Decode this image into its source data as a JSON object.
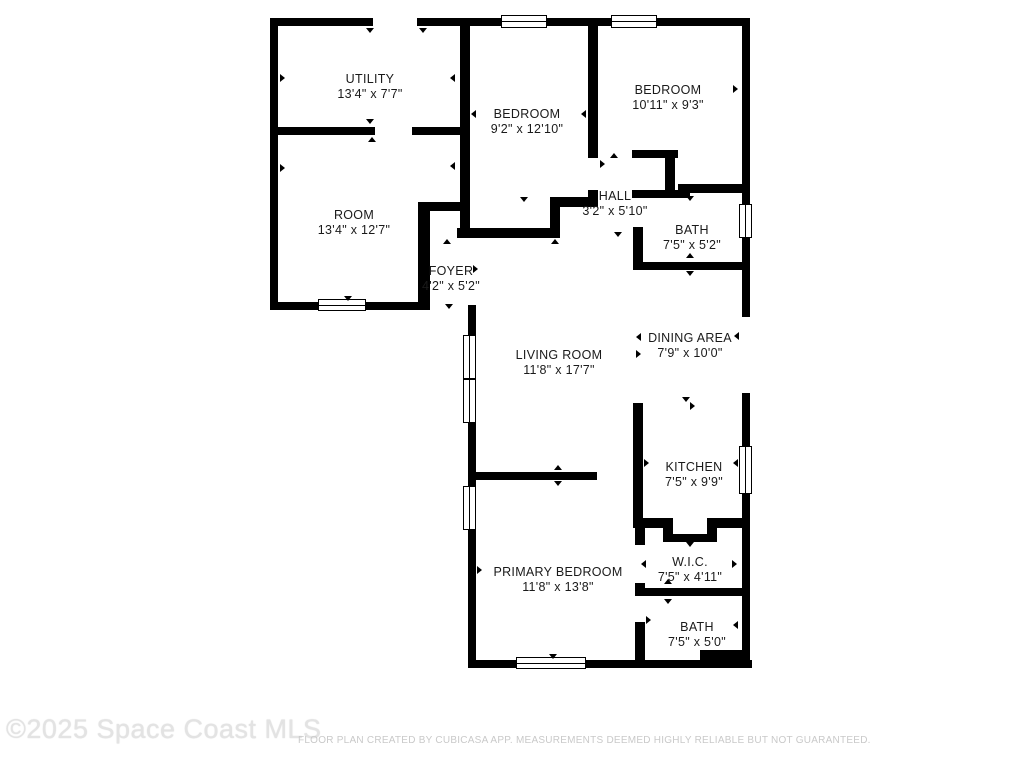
{
  "watermark": "©2025 Space Coast MLS",
  "disclaimer": "FLOOR PLAN CREATED BY CUBICASA APP. MEASUREMENTS DEEMED HIGHLY RELIABLE BUT NOT GUARANTEED.",
  "colors": {
    "wall": "#000000",
    "text": "#1a1a1a",
    "background": "#ffffff",
    "watermark": "#e3e3e3",
    "disclaimer": "#c9c9c9"
  },
  "floor_plan": {
    "rooms": [
      {
        "id": "utility",
        "name": "UTILITY",
        "dims": "13'4\" x 7'7\"",
        "cx": 370,
        "cy": 80
      },
      {
        "id": "bedroom-1",
        "name": "BEDROOM",
        "dims": "9'2\" x 12'10\"",
        "cx": 527,
        "cy": 115
      },
      {
        "id": "bedroom-2",
        "name": "BEDROOM",
        "dims": "10'11\" x 9'3\"",
        "cx": 668,
        "cy": 91
      },
      {
        "id": "room",
        "name": "ROOM",
        "dims": "13'4\" x 12'7\"",
        "cx": 354,
        "cy": 216
      },
      {
        "id": "hall",
        "name": "HALL",
        "dims": "3'2\" x 5'10\"",
        "cx": 615,
        "cy": 197
      },
      {
        "id": "bath-1",
        "name": "BATH",
        "dims": "7'5\" x 5'2\"",
        "cx": 692,
        "cy": 231
      },
      {
        "id": "foyer",
        "name": "FOYER",
        "dims": "4'2\" x 5'2\"",
        "cx": 451,
        "cy": 272
      },
      {
        "id": "living-room",
        "name": "LIVING ROOM",
        "dims": "11'8\" x 17'7\"",
        "cx": 559,
        "cy": 356
      },
      {
        "id": "dining-area",
        "name": "DINING AREA",
        "dims": "7'9\" x 10'0\"",
        "cx": 690,
        "cy": 339
      },
      {
        "id": "kitchen",
        "name": "KITCHEN",
        "dims": "7'5\" x 9'9\"",
        "cx": 694,
        "cy": 468
      },
      {
        "id": "wic",
        "name": "W.I.C.",
        "dims": "7'5\" x 4'11\"",
        "cx": 690,
        "cy": 563
      },
      {
        "id": "primary-bedroom",
        "name": "PRIMARY BEDROOM",
        "dims": "11'8\" x 13'8\"",
        "cx": 558,
        "cy": 573
      },
      {
        "id": "bath-2",
        "name": "BATH",
        "dims": "7'5\" x 5'0\"",
        "cx": 697,
        "cy": 628
      }
    ],
    "walls": [
      [
        270,
        18,
        103,
        8
      ],
      [
        417,
        18,
        86,
        8
      ],
      [
        547,
        18,
        66,
        8
      ],
      [
        657,
        18,
        93,
        8
      ],
      [
        270,
        18,
        8,
        292
      ],
      [
        270,
        302,
        52,
        8
      ],
      [
        364,
        302,
        59,
        8
      ],
      [
        468,
        305,
        8,
        363
      ],
      [
        468,
        660,
        50,
        8
      ],
      [
        586,
        660,
        166,
        8
      ],
      [
        742,
        18,
        8,
        187
      ],
      [
        742,
        238,
        8,
        79
      ],
      [
        742,
        393,
        8,
        55
      ],
      [
        742,
        493,
        8,
        175
      ],
      [
        460,
        18,
        10,
        220
      ],
      [
        278,
        127,
        97,
        8
      ],
      [
        412,
        127,
        56,
        8
      ],
      [
        588,
        26,
        10,
        132
      ],
      [
        588,
        190,
        10,
        17
      ],
      [
        552,
        197,
        46,
        10
      ],
      [
        550,
        197,
        10,
        41
      ],
      [
        457,
        228,
        103,
        10
      ],
      [
        418,
        202,
        44,
        9
      ],
      [
        418,
        202,
        12,
        108
      ],
      [
        632,
        150,
        46,
        8
      ],
      [
        665,
        150,
        10,
        48
      ],
      [
        632,
        190,
        58,
        8
      ],
      [
        678,
        184,
        64,
        9
      ],
      [
        633,
        227,
        10,
        43
      ],
      [
        633,
        262,
        109,
        8
      ],
      [
        633,
        403,
        10,
        125
      ],
      [
        473,
        472,
        124,
        8
      ],
      [
        637,
        518,
        36,
        10
      ],
      [
        663,
        518,
        10,
        24
      ],
      [
        663,
        534,
        54,
        8
      ],
      [
        707,
        518,
        10,
        24
      ],
      [
        707,
        518,
        38,
        10
      ],
      [
        635,
        528,
        10,
        17
      ],
      [
        635,
        583,
        10,
        13
      ],
      [
        635,
        588,
        107,
        8
      ],
      [
        635,
        622,
        10,
        46
      ],
      [
        700,
        650,
        42,
        10
      ]
    ],
    "windows": [
      {
        "x": 501,
        "y": 15,
        "w": 46,
        "h": 13,
        "dir": "h"
      },
      {
        "x": 611,
        "y": 15,
        "w": 46,
        "h": 13,
        "dir": "h"
      },
      {
        "x": 318,
        "y": 299,
        "w": 48,
        "h": 12,
        "dir": "h"
      },
      {
        "x": 516,
        "y": 657,
        "w": 70,
        "h": 12,
        "dir": "h"
      },
      {
        "x": 739,
        "y": 204,
        "w": 13,
        "h": 34,
        "dir": "v"
      },
      {
        "x": 739,
        "y": 446,
        "w": 13,
        "h": 48,
        "dir": "v"
      },
      {
        "x": 463,
        "y": 335,
        "w": 13,
        "h": 44,
        "dir": "v"
      },
      {
        "x": 463,
        "y": 379,
        "w": 13,
        "h": 44,
        "dir": "v"
      },
      {
        "x": 463,
        "y": 486,
        "w": 13,
        "h": 44,
        "dir": "v"
      }
    ],
    "door_markers": [
      [
        366,
        28,
        "down"
      ],
      [
        419,
        28,
        "down"
      ],
      [
        280,
        74,
        "right"
      ],
      [
        450,
        74,
        "left"
      ],
      [
        366,
        119,
        "down"
      ],
      [
        368,
        137,
        "up"
      ],
      [
        280,
        164,
        "right"
      ],
      [
        450,
        162,
        "left"
      ],
      [
        471,
        110,
        "left"
      ],
      [
        581,
        110,
        "left"
      ],
      [
        600,
        160,
        "right"
      ],
      [
        610,
        153,
        "up"
      ],
      [
        520,
        197,
        "down"
      ],
      [
        686,
        196,
        "down"
      ],
      [
        443,
        239,
        "up"
      ],
      [
        551,
        239,
        "up"
      ],
      [
        420,
        265,
        "left"
      ],
      [
        473,
        265,
        "right"
      ],
      [
        614,
        232,
        "down"
      ],
      [
        445,
        304,
        "down"
      ],
      [
        344,
        296,
        "down"
      ],
      [
        686,
        253,
        "up"
      ],
      [
        686,
        271,
        "down"
      ],
      [
        733,
        85,
        "right"
      ],
      [
        734,
        332,
        "left"
      ],
      [
        636,
        333,
        "left"
      ],
      [
        636,
        350,
        "right"
      ],
      [
        682,
        397,
        "down"
      ],
      [
        690,
        402,
        "right"
      ],
      [
        644,
        459,
        "right"
      ],
      [
        733,
        459,
        "left"
      ],
      [
        554,
        465,
        "up"
      ],
      [
        554,
        481,
        "down"
      ],
      [
        686,
        542,
        "down"
      ],
      [
        641,
        560,
        "left"
      ],
      [
        732,
        560,
        "right"
      ],
      [
        664,
        579,
        "up"
      ],
      [
        664,
        599,
        "down"
      ],
      [
        646,
        616,
        "right"
      ],
      [
        733,
        621,
        "left"
      ],
      [
        549,
        654,
        "down"
      ],
      [
        477,
        566,
        "right"
      ]
    ]
  }
}
